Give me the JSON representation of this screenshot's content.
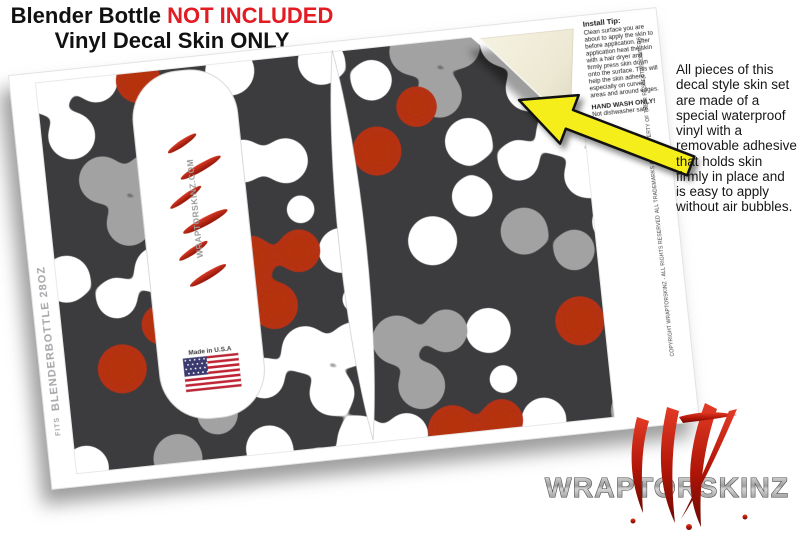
{
  "header": {
    "product": "Blender Bottle ",
    "not_included": "NOT INCLUDED",
    "subtitle": "Vinyl Decal Skin ONLY"
  },
  "install_tip": {
    "title": "Install Tip:",
    "body": "Clean surface you are about to apply the skin to before application. After application heat the skin with a hair dryer and firmly press skin down onto the surface. This will help the skin adhere, especially on curved areas and around edges.",
    "hand_wash": "HAND WASH ONLY!",
    "dishwasher": "Not dishwasher safe."
  },
  "side_note": {
    "text": "All pieces of this decal style  skin set are made of a special waterproof vinyl with a removable adhesive that holds skin firmly in place and is easy to apply without air bubbles."
  },
  "sheet": {
    "fits_prefix": "FITS",
    "fits_label": "BLENDERBOTTLE 28OZ",
    "made_in": "Made in U.S.A",
    "capsule_logo": "WRAPTORSKINZ.COM",
    "copyright1": "COPYRIGHT WRAPTORSKINZ - ALL RIGHTS RESERVED",
    "copyright2": "ALL TRADEMARKS ARE PROPERTY OF THEIR RESPECTIVE OWNERS"
  },
  "brand": {
    "logo": "WRAPTORSKINZ"
  },
  "colors": {
    "pattern_background": "#3c3b3d",
    "node_white": "#ffffff",
    "node_gray": "#a2a2a2",
    "node_red": "#b5310f",
    "accent_red": "#e31b23",
    "arrow_yellow": "#f6ee1b",
    "backing_cream": "#f0edda"
  }
}
